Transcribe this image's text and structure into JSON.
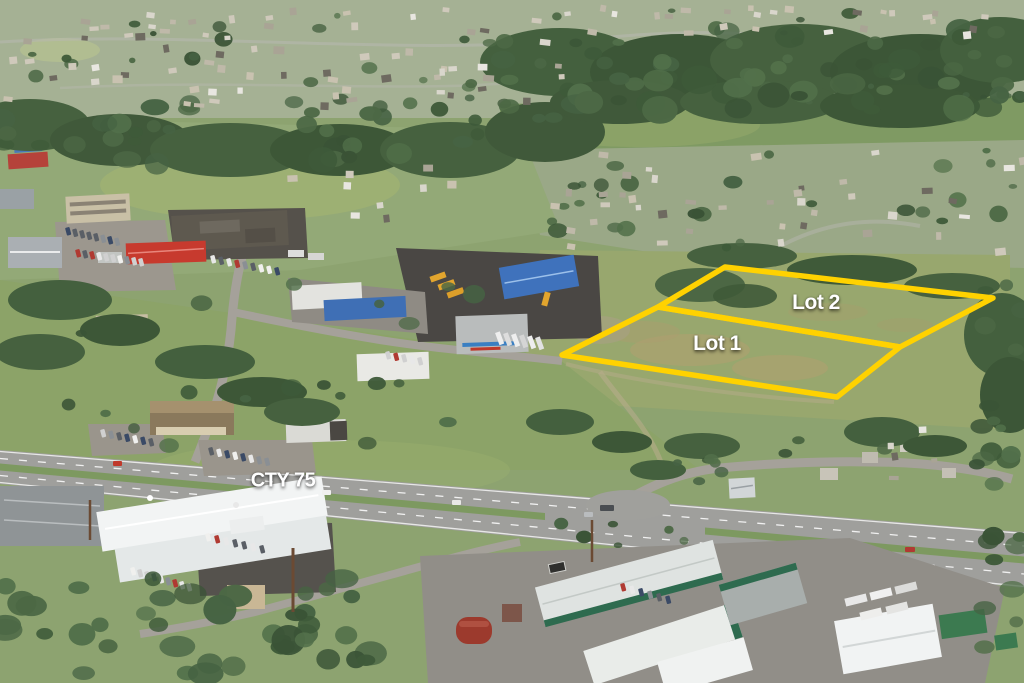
{
  "annotations": {
    "lot1": {
      "label": "Lot 1"
    },
    "lot2": {
      "label": "Lot 2"
    },
    "highway": {
      "label": "CTY 75"
    },
    "outline_color": "#FFD200",
    "label_color": "#FFFFFF"
  }
}
